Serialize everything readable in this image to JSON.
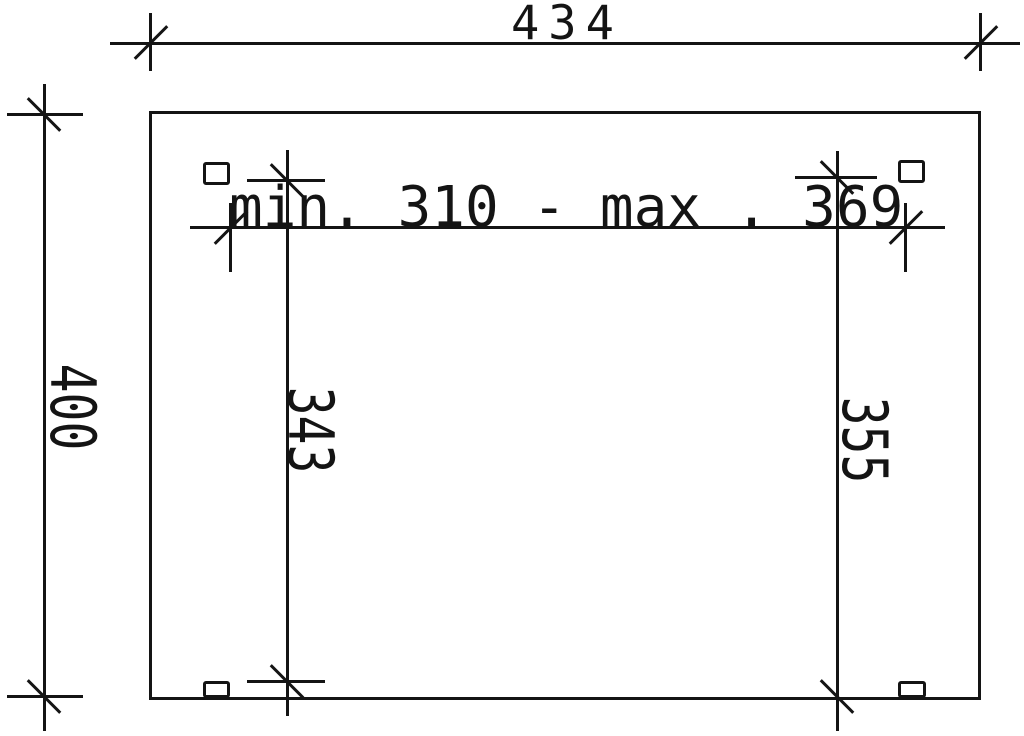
{
  "drawing": {
    "background_color": "#ffffff",
    "line_color": "#141414",
    "labels": {
      "overall_width": "434",
      "overall_depth": "400",
      "inner_span": "min. 310 - max . 369",
      "inner_height_left": "343",
      "inner_height_right": "355"
    }
  }
}
